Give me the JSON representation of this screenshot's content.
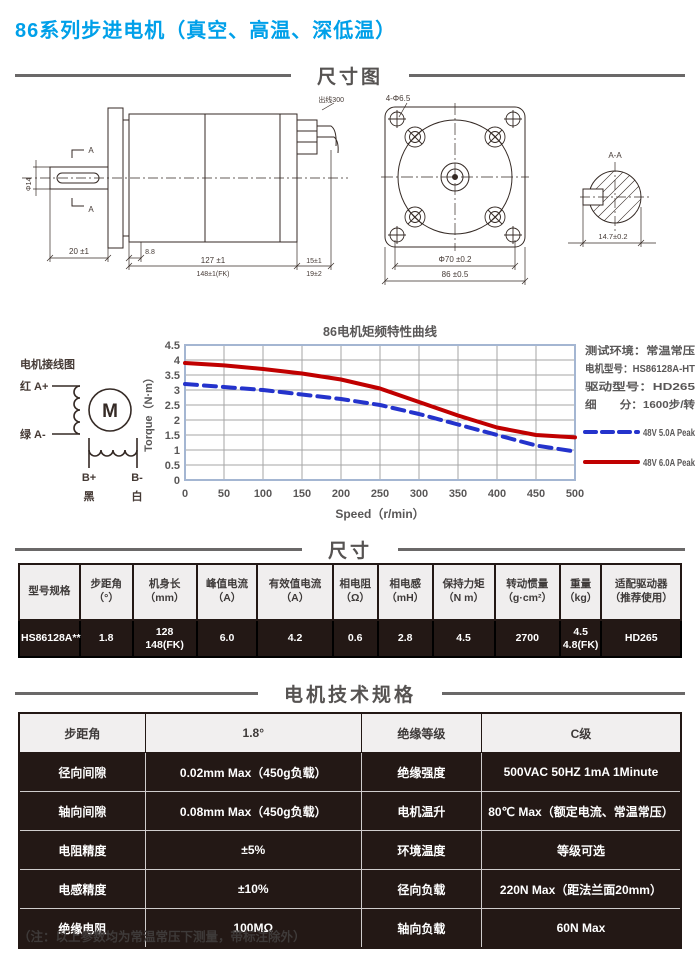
{
  "page": {
    "title": "86系列步进电机（真空、高温、深低温）",
    "note": "（注：以上参数均为常温常压下测量，带标注除外）"
  },
  "sections": {
    "dimension_diagram": "尺寸图",
    "size": "尺寸",
    "specs": "电机技术规格"
  },
  "drawing": {
    "wire_note": "出线300",
    "section_mark_top": "A",
    "section_mark_bottom": "A",
    "dim_shaft_dia": "Φ14",
    "dim_front": "20 ±1",
    "dim_step": "8.8",
    "dim_body": "127 ±1",
    "dim_body_fk": "148±1(FK)",
    "dim_rear": "15±1",
    "dim_rear2": "19±2",
    "front_holes": "4-Φ6.5",
    "front_dia": "Φ70 ±0.2",
    "front_square": "86 ±0.5",
    "section_label": "A-A",
    "section_dim": "14.7±0.2"
  },
  "wiring": {
    "title": "电机接线图",
    "a_plus": "红 A+",
    "a_minus": "绿 A-",
    "b_plus": "B+",
    "b_minus": "B-",
    "black": "黑",
    "white": "白",
    "motor": "M"
  },
  "chart_data": {
    "type": "line",
    "title": "86电机矩频特性曲线",
    "xlabel": "Speed（r/min）",
    "ylabel": "Torque（N·m）",
    "xlim": [
      0,
      500
    ],
    "ylim": [
      0,
      4.5
    ],
    "xticks": [
      0,
      50,
      100,
      150,
      200,
      250,
      300,
      350,
      400,
      450,
      500
    ],
    "yticks": [
      0,
      0.5,
      1,
      1.5,
      2,
      2.5,
      3,
      3.5,
      4,
      4.5
    ],
    "grid": true,
    "legend_position": "right",
    "x": [
      0,
      50,
      100,
      150,
      200,
      250,
      300,
      350,
      400,
      450,
      500
    ],
    "series": [
      {
        "name": "48V 5.0A Peak",
        "color": "#2433cc",
        "style": "dashed",
        "values": [
          3.2,
          3.1,
          3.0,
          2.85,
          2.7,
          2.5,
          2.2,
          1.85,
          1.5,
          1.15,
          0.95
        ]
      },
      {
        "name": "48V 6.0A Peak",
        "color": "#c00000",
        "style": "solid",
        "values": [
          3.9,
          3.82,
          3.7,
          3.55,
          3.35,
          3.05,
          2.6,
          2.15,
          1.75,
          1.5,
          1.42
        ]
      }
    ],
    "info_lines": [
      "测试环境：常温常压",
      "电机型号：HS86128A-HT",
      "驱动型号：HD265",
      "细　　分：1600步/转"
    ]
  },
  "size_table": {
    "headers": [
      [
        "型号规格"
      ],
      [
        "步距角",
        "（°）"
      ],
      [
        "机身长",
        "（mm）"
      ],
      [
        "峰值电流",
        "（A）"
      ],
      [
        "有效值电流",
        "（A）"
      ],
      [
        "相电阻",
        "（Ω）"
      ],
      [
        "相电感",
        "（mH）"
      ],
      [
        "保持力矩",
        "（N m）"
      ],
      [
        "转动惯量",
        "（g·cm²）"
      ],
      [
        "重量",
        "（kg）"
      ],
      [
        "适配驱动器",
        "（推荐使用）"
      ]
    ],
    "row": [
      [
        "HS86128A**"
      ],
      [
        "1.8"
      ],
      [
        "128",
        "148(FK)"
      ],
      [
        "6.0"
      ],
      [
        "4.2"
      ],
      [
        "0.6"
      ],
      [
        "2.8"
      ],
      [
        "4.5"
      ],
      [
        "2700"
      ],
      [
        "4.5",
        "4.8(FK)"
      ],
      [
        "HD265"
      ]
    ]
  },
  "spec_table": {
    "rows": [
      [
        "步距角",
        "1.8°",
        "绝缘等级",
        "C级"
      ],
      [
        "径向间隙",
        "0.02mm Max（450g负载）",
        "绝缘强度",
        "500VAC 50HZ 1mA 1Minute"
      ],
      [
        "轴向间隙",
        "0.08mm Max（450g负载）",
        "电机温升",
        "80℃ Max（额定电流、常温常压）"
      ],
      [
        "电阻精度",
        "±5%",
        "环境温度",
        "等级可选"
      ],
      [
        "电感精度",
        "±10%",
        "径向负载",
        "220N Max（距法兰面20mm）"
      ],
      [
        "绝缘电阻",
        "100MΩ",
        "轴向负载",
        "60N  Max"
      ]
    ]
  },
  "colors": {
    "accent_blue": "#00a0e9",
    "dark_cell": "#231815",
    "header_cell": "#f0eeee",
    "grid_line": "#a6a6a6",
    "plot_border": "#a4b6d2",
    "divider": "#6a6868",
    "text_gray": "#595757"
  }
}
